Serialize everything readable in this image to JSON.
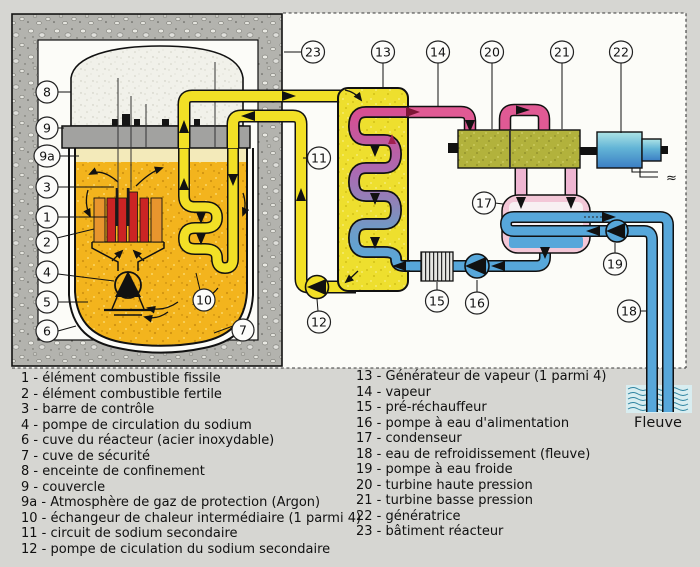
{
  "callouts": {
    "c1": "1",
    "c2": "2",
    "c3": "3",
    "c4": "4",
    "c5": "5",
    "c6": "6",
    "c7": "7",
    "c8": "8",
    "c9": "9",
    "c9a": "9a",
    "c10": "10",
    "c11": "11",
    "c12": "12",
    "c13": "13",
    "c14": "14",
    "c15": "15",
    "c16": "16",
    "c17": "17",
    "c18": "18",
    "c19": "19",
    "c20": "20",
    "c21": "21",
    "c22": "22",
    "c23": "23"
  },
  "river_label": "Fleuve",
  "electric_symbol": "≈",
  "legend": {
    "left": [
      "1 - élément combustible fissile",
      "2 - élément combustible fertile",
      "3 - barre de contrôle",
      "4 - pompe de circulation du sodium",
      "6 - cuve du réacteur (acier inoxydable)",
      "7 - cuve de sécurité",
      "8 - enceinte de confinement",
      "9 - couvercle",
      "9a - Atmosphère de gaz de protection (Argon)",
      "10 - échangeur de chaleur intermédiaire (1 parmi 4)",
      "11 - circuit de sodium secondaire",
      "12 - pompe de ciculation du sodium secondaire"
    ],
    "right": [
      "13 - Générateur de vapeur (1 parmi 4)",
      "14 - vapeur",
      "15 - pré-réchauffeur",
      "16 - pompe à eau d'alimentation",
      "17 - condenseur",
      "18 - eau de refroidissement (fleuve)",
      "19 - pompe à eau froide",
      "20 - turbine haute pression",
      "21 - turbine basse pression",
      "22 - génératrice",
      "23 - bâtiment réacteur"
    ]
  },
  "colors": {
    "page_bg": "#d6d6d2",
    "sodium": "#f3b41d",
    "secondary_sodium_pipe": "#f2e026",
    "steam_pink": "#e05a94",
    "water_blue": "#57a7da",
    "turbine_olive": "#b2b23c",
    "generator_teal": "#62b4d6",
    "condenser_pink": "#f3c7d7",
    "concrete_gray": "#b3b3ae",
    "fuel_fissile_red": "#cb2424",
    "fuel_fertile_orange": "#e8952e"
  }
}
